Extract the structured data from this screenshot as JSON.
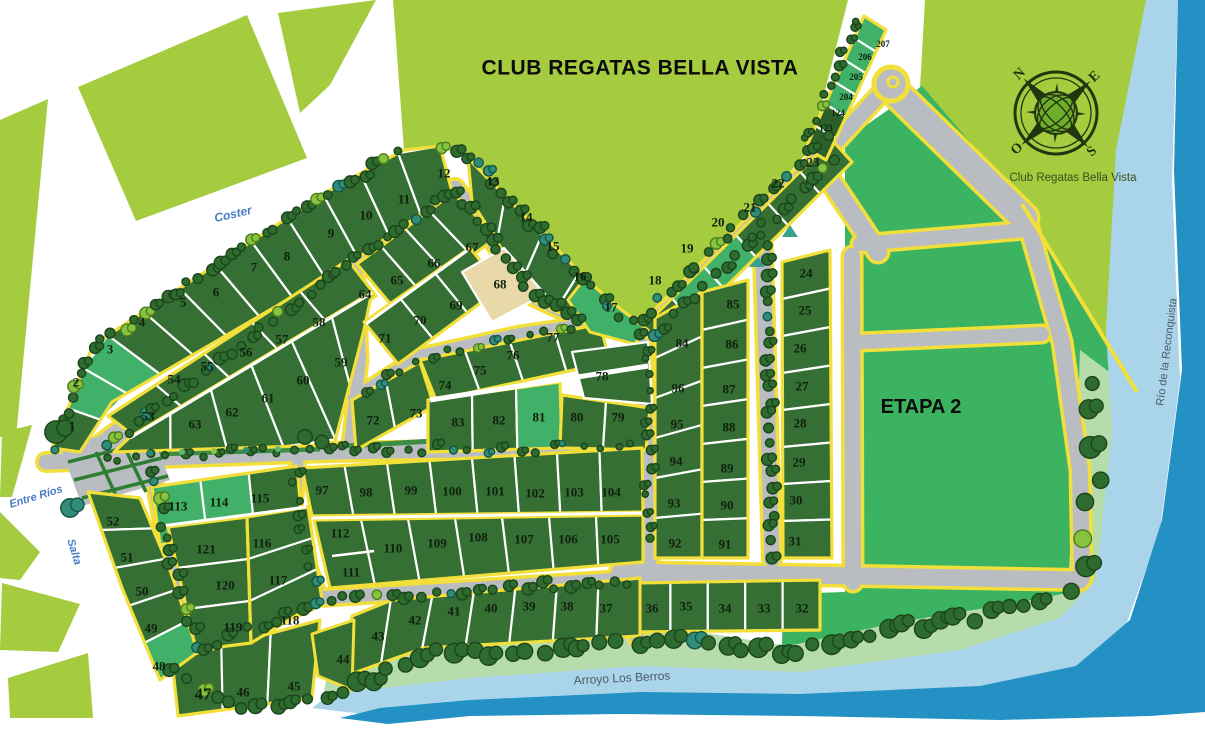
{
  "title": "CLUB REGATAS BELLA VISTA",
  "region_labels": {
    "etapa2": "ETAPA 2",
    "compass_caption": "Club Regatas Bella Vista"
  },
  "streets": [
    {
      "id": "coster",
      "name": "Coster",
      "x": 233,
      "y": 214,
      "rot": -13,
      "size": 12
    },
    {
      "id": "entre-rios",
      "name": "Entre Ríos",
      "x": 36,
      "y": 497,
      "rot": -17,
      "size": 11
    },
    {
      "id": "salta",
      "name": "Salta",
      "x": 74,
      "y": 552,
      "rot": 73,
      "size": 11
    }
  ],
  "waterways": [
    {
      "id": "arroyo",
      "name": "Arroyo Los Berros",
      "x": 622,
      "y": 678,
      "rot": -3,
      "size": 12
    },
    {
      "id": "rio",
      "name": "Río de la Reconquista",
      "x": 1167,
      "y": 352,
      "rot": -83,
      "size": 11
    }
  ],
  "compass": {
    "points": [
      "N",
      "E",
      "S",
      "O"
    ]
  },
  "colors": {
    "bright_green": "#a5cb3f",
    "medium_green": "#41b068",
    "etapa_green": "#3cb360",
    "lot_dark": "#356f34",
    "lot_darker": "#2c5f2a",
    "lot_beige": "#ead9a8",
    "road_grey": "#b9bdc1",
    "border_yellow": "#f2df3a",
    "bank_green": "#b7dcab",
    "river_light": "#aad4ea",
    "river_dark": "#2391c4",
    "street_blue": "#4a7cc7",
    "water_label": "#4c5a66"
  },
  "lots": [
    {
      "n": "1",
      "x": 72,
      "y": 426
    },
    {
      "n": "2",
      "x": 76,
      "y": 382
    },
    {
      "n": "3",
      "x": 110,
      "y": 349
    },
    {
      "n": "4",
      "x": 142,
      "y": 322
    },
    {
      "n": "5",
      "x": 183,
      "y": 302
    },
    {
      "n": "6",
      "x": 216,
      "y": 292
    },
    {
      "n": "7",
      "x": 254,
      "y": 267
    },
    {
      "n": "8",
      "x": 287,
      "y": 256
    },
    {
      "n": "9",
      "x": 331,
      "y": 233
    },
    {
      "n": "10",
      "x": 366,
      "y": 215
    },
    {
      "n": "11",
      "x": 404,
      "y": 199
    },
    {
      "n": "12",
      "x": 444,
      "y": 173
    },
    {
      "n": "13",
      "x": 493,
      "y": 181
    },
    {
      "n": "14",
      "x": 526,
      "y": 217
    },
    {
      "n": "15",
      "x": 553,
      "y": 246
    },
    {
      "n": "16",
      "x": 580,
      "y": 276
    },
    {
      "n": "17",
      "x": 611,
      "y": 307
    },
    {
      "n": "18",
      "x": 655,
      "y": 280
    },
    {
      "n": "19",
      "x": 687,
      "y": 248
    },
    {
      "n": "20",
      "x": 718,
      "y": 222
    },
    {
      "n": "21",
      "x": 750,
      "y": 207
    },
    {
      "n": "22",
      "x": 778,
      "y": 183
    },
    {
      "n": "23",
      "x": 813,
      "y": 162
    },
    {
      "n": "123",
      "x": 826,
      "y": 128,
      "s": 9
    },
    {
      "n": "124",
      "x": 838,
      "y": 113,
      "s": 9
    },
    {
      "n": "204",
      "x": 846,
      "y": 97,
      "s": 9
    },
    {
      "n": "205",
      "x": 856,
      "y": 77,
      "s": 9
    },
    {
      "n": "206",
      "x": 865,
      "y": 57,
      "s": 9
    },
    {
      "n": "207",
      "x": 883,
      "y": 44,
      "s": 9
    },
    {
      "n": "24",
      "x": 806,
      "y": 273
    },
    {
      "n": "25",
      "x": 805,
      "y": 310
    },
    {
      "n": "26",
      "x": 800,
      "y": 348
    },
    {
      "n": "27",
      "x": 802,
      "y": 386
    },
    {
      "n": "28",
      "x": 800,
      "y": 423
    },
    {
      "n": "29",
      "x": 799,
      "y": 462
    },
    {
      "n": "30",
      "x": 796,
      "y": 500
    },
    {
      "n": "31",
      "x": 795,
      "y": 541
    },
    {
      "n": "32",
      "x": 802,
      "y": 608
    },
    {
      "n": "33",
      "x": 764,
      "y": 608
    },
    {
      "n": "34",
      "x": 725,
      "y": 608
    },
    {
      "n": "35",
      "x": 686,
      "y": 606
    },
    {
      "n": "36",
      "x": 652,
      "y": 608
    },
    {
      "n": "37",
      "x": 606,
      "y": 608
    },
    {
      "n": "38",
      "x": 567,
      "y": 606
    },
    {
      "n": "39",
      "x": 529,
      "y": 606
    },
    {
      "n": "40",
      "x": 491,
      "y": 608
    },
    {
      "n": "41",
      "x": 454,
      "y": 611
    },
    {
      "n": "42",
      "x": 415,
      "y": 620
    },
    {
      "n": "43",
      "x": 378,
      "y": 636
    },
    {
      "n": "44",
      "x": 343,
      "y": 659
    },
    {
      "n": "45",
      "x": 294,
      "y": 686
    },
    {
      "n": "46",
      "x": 243,
      "y": 692
    },
    {
      "n": "47",
      "x": 203,
      "y": 694,
      "s": 17
    },
    {
      "n": "48",
      "x": 159,
      "y": 666
    },
    {
      "n": "49",
      "x": 151,
      "y": 628
    },
    {
      "n": "50",
      "x": 142,
      "y": 591
    },
    {
      "n": "51",
      "x": 127,
      "y": 557
    },
    {
      "n": "52",
      "x": 113,
      "y": 521
    },
    {
      "n": "53",
      "x": 148,
      "y": 416
    },
    {
      "n": "54",
      "x": 174,
      "y": 379
    },
    {
      "n": "55",
      "x": 207,
      "y": 366
    },
    {
      "n": "56",
      "x": 246,
      "y": 352
    },
    {
      "n": "57",
      "x": 282,
      "y": 339
    },
    {
      "n": "58",
      "x": 319,
      "y": 322
    },
    {
      "n": "59",
      "x": 341,
      "y": 362
    },
    {
      "n": "60",
      "x": 303,
      "y": 380
    },
    {
      "n": "61",
      "x": 268,
      "y": 398
    },
    {
      "n": "62",
      "x": 232,
      "y": 412
    },
    {
      "n": "63",
      "x": 195,
      "y": 424
    },
    {
      "n": "64",
      "x": 365,
      "y": 294
    },
    {
      "n": "65",
      "x": 397,
      "y": 280
    },
    {
      "n": "66",
      "x": 434,
      "y": 263
    },
    {
      "n": "67",
      "x": 472,
      "y": 247
    },
    {
      "n": "68",
      "x": 500,
      "y": 284
    },
    {
      "n": "69",
      "x": 456,
      "y": 305
    },
    {
      "n": "70",
      "x": 420,
      "y": 320
    },
    {
      "n": "71",
      "x": 385,
      "y": 338
    },
    {
      "n": "72",
      "x": 373,
      "y": 420
    },
    {
      "n": "73",
      "x": 416,
      "y": 413
    },
    {
      "n": "74",
      "x": 445,
      "y": 385
    },
    {
      "n": "75",
      "x": 480,
      "y": 370
    },
    {
      "n": "76",
      "x": 513,
      "y": 355
    },
    {
      "n": "77",
      "x": 553,
      "y": 337
    },
    {
      "n": "78",
      "x": 602,
      "y": 376
    },
    {
      "n": "79",
      "x": 618,
      "y": 417
    },
    {
      "n": "80",
      "x": 577,
      "y": 417
    },
    {
      "n": "81",
      "x": 539,
      "y": 417
    },
    {
      "n": "82",
      "x": 499,
      "y": 420
    },
    {
      "n": "83",
      "x": 458,
      "y": 422
    },
    {
      "n": "84",
      "x": 682,
      "y": 343
    },
    {
      "n": "85",
      "x": 733,
      "y": 304
    },
    {
      "n": "86",
      "x": 732,
      "y": 344
    },
    {
      "n": "87",
      "x": 729,
      "y": 389
    },
    {
      "n": "88",
      "x": 729,
      "y": 427
    },
    {
      "n": "89",
      "x": 727,
      "y": 468
    },
    {
      "n": "90",
      "x": 727,
      "y": 505
    },
    {
      "n": "91",
      "x": 725,
      "y": 544
    },
    {
      "n": "92",
      "x": 675,
      "y": 543
    },
    {
      "n": "93",
      "x": 674,
      "y": 503
    },
    {
      "n": "94",
      "x": 676,
      "y": 461
    },
    {
      "n": "95",
      "x": 677,
      "y": 424
    },
    {
      "n": "96",
      "x": 678,
      "y": 388
    },
    {
      "n": "97",
      "x": 322,
      "y": 490
    },
    {
      "n": "98",
      "x": 366,
      "y": 492
    },
    {
      "n": "99",
      "x": 411,
      "y": 490
    },
    {
      "n": "100",
      "x": 452,
      "y": 491
    },
    {
      "n": "101",
      "x": 495,
      "y": 491
    },
    {
      "n": "102",
      "x": 535,
      "y": 493
    },
    {
      "n": "103",
      "x": 574,
      "y": 492
    },
    {
      "n": "104",
      "x": 611,
      "y": 492
    },
    {
      "n": "105",
      "x": 610,
      "y": 539
    },
    {
      "n": "106",
      "x": 568,
      "y": 539
    },
    {
      "n": "107",
      "x": 524,
      "y": 539
    },
    {
      "n": "108",
      "x": 478,
      "y": 537
    },
    {
      "n": "109",
      "x": 437,
      "y": 543
    },
    {
      "n": "110",
      "x": 393,
      "y": 548
    },
    {
      "n": "111",
      "x": 351,
      "y": 572
    },
    {
      "n": "112",
      "x": 340,
      "y": 533
    },
    {
      "n": "113",
      "x": 178,
      "y": 506
    },
    {
      "n": "114",
      "x": 219,
      "y": 502
    },
    {
      "n": "115",
      "x": 260,
      "y": 498
    },
    {
      "n": "116",
      "x": 262,
      "y": 543
    },
    {
      "n": "117",
      "x": 278,
      "y": 580
    },
    {
      "n": "118",
      "x": 290,
      "y": 620
    },
    {
      "n": "119",
      "x": 233,
      "y": 627
    },
    {
      "n": "120",
      "x": 225,
      "y": 585
    },
    {
      "n": "121",
      "x": 206,
      "y": 549
    }
  ]
}
